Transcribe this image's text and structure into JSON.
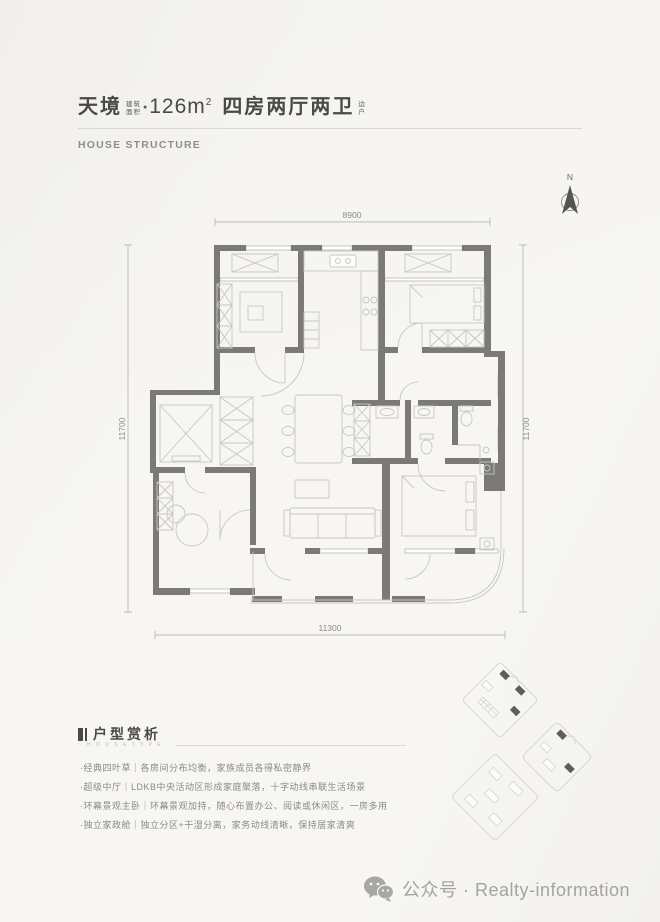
{
  "header": {
    "project_name": "天境",
    "area_label_top": "建筑",
    "area_label_bottom": "面积",
    "dot": "●",
    "area_value": "126m",
    "area_sup": "2",
    "layout_text": "四房两厅两卫",
    "side_label_top": "边",
    "side_label_bottom": "户",
    "subtitle": "HOUSE STRUCTURE"
  },
  "compass": {
    "north_label": "N"
  },
  "floorplan": {
    "dim_top": "8900",
    "dim_left": "11700",
    "dim_right": "11700",
    "dim_bottom": "11300"
  },
  "analysis": {
    "title": "户型赏析",
    "micro_label": "· H O U S E T Y P E ·",
    "items": [
      "·经典四叶草｜各房间分布均衡，家族成员各得私密静界",
      "·超级中厅｜LDKB中央活动区形成家庭聚落，十字动线串联生活场景",
      "·环幕景观主卧｜环幕景观加持，随心布置办公、阅读或休闲区，一房多用",
      "·独立家政舱｜独立分区+干湿分离，家务动线清晰，保持居家清爽"
    ]
  },
  "footer": {
    "label": "公众号 · Realty-information"
  },
  "colors": {
    "paper": "#f7f6f3",
    "ink_dark": "#4a4946",
    "wall_gray": "#7b7a76",
    "line_light": "#c7c6c1",
    "text_gray": "#8a8984"
  }
}
